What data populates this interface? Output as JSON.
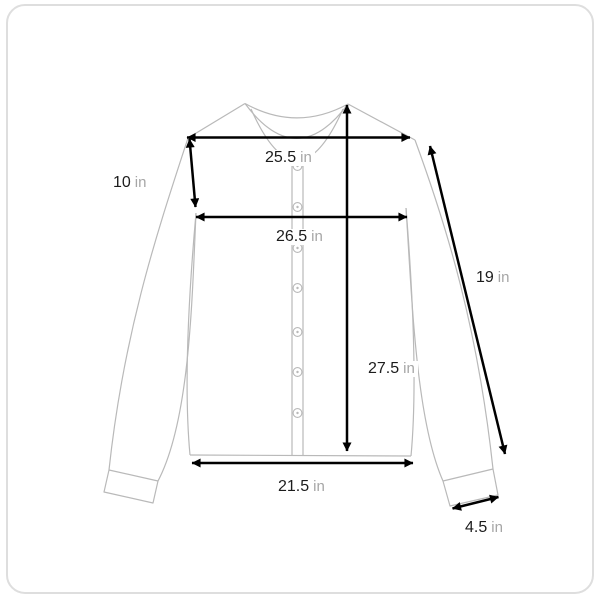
{
  "diagram": {
    "type": "garment-measurement-diagram",
    "garment": "cardigan-front-view",
    "unit_system": "in",
    "colors": {
      "outline": "#b9b9b9",
      "frame_border": "#dedede",
      "arrow": "#000000",
      "value_text": "#1c1c1c",
      "unit_text": "#a6a6a6",
      "background": "#ffffff"
    },
    "button_count": 7,
    "measurements": {
      "shoulder_width": {
        "value": "25.5",
        "unit": "in"
      },
      "armhole_depth": {
        "value": "10",
        "unit": "in"
      },
      "chest_width": {
        "value": "26.5",
        "unit": "in"
      },
      "sleeve_length": {
        "value": "19",
        "unit": "in"
      },
      "body_length": {
        "value": "27.5",
        "unit": "in"
      },
      "hem_width": {
        "value": "21.5",
        "unit": "in"
      },
      "cuff_width": {
        "value": "4.5",
        "unit": "in"
      }
    }
  }
}
